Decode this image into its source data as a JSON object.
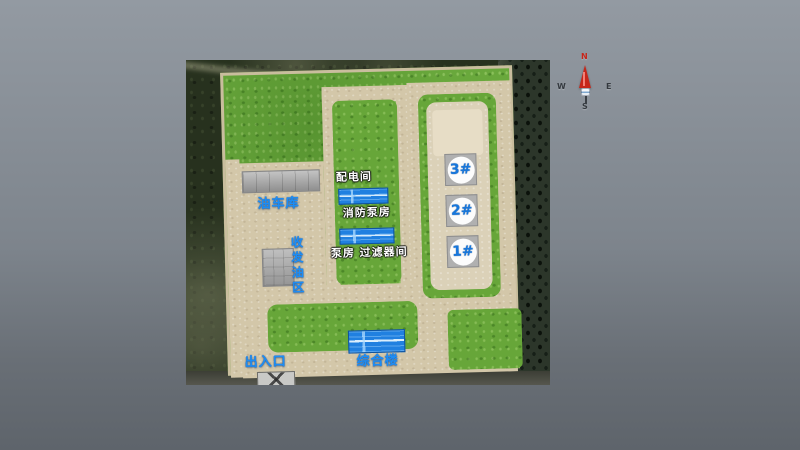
{
  "scene": {
    "type": "3d-site-plan-view",
    "labels": {
      "garage": "油车库",
      "power_distribution": "配电间",
      "fire_pump": "消防泵房",
      "oil_dispatch": "收发油区",
      "pump_filter": "泵房 过滤器间",
      "complex_building": "综合楼",
      "entrance": "出入口"
    },
    "tanks": [
      {
        "id": "3#"
      },
      {
        "id": "2#"
      },
      {
        "id": "1#"
      }
    ],
    "colors": {
      "grass": "#69a83c",
      "road": "#d3c7a9",
      "containment": "#dbd1b8",
      "blue_building": "#2080e0",
      "gray_building": "#aaaaaa",
      "label_blue": "#1d8df5",
      "label_white": "#ffffff",
      "compass_north": "#c6261a"
    }
  },
  "compass": {
    "north": "N",
    "west": "W",
    "east": "E",
    "south": "S"
  }
}
